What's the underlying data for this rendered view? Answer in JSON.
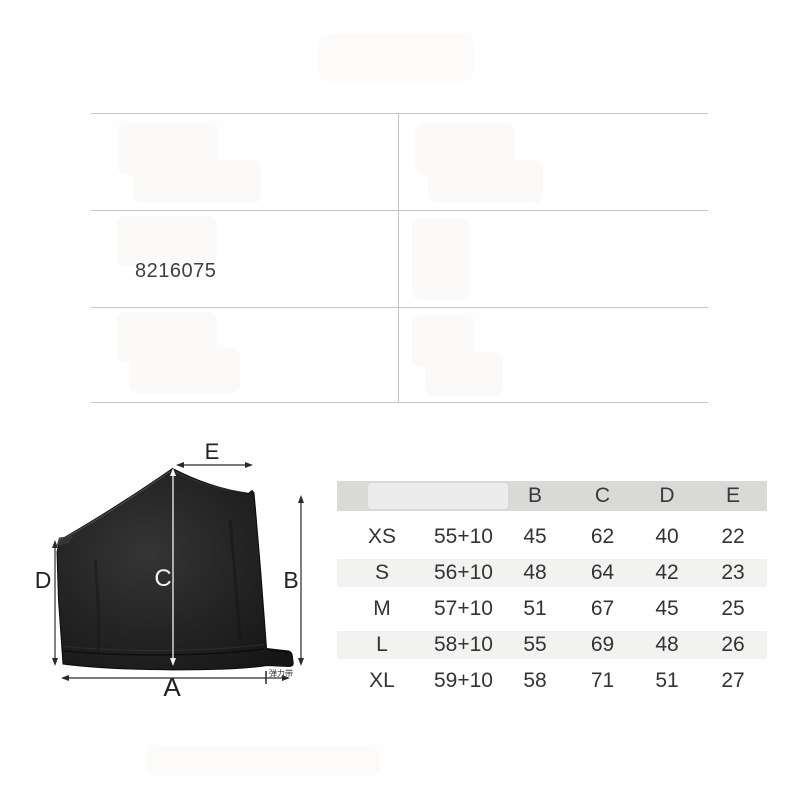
{
  "page": {
    "background": "#ffffff",
    "grid_line_color": "#c6c6c6"
  },
  "product_table": {
    "code": "8216075"
  },
  "diagram": {
    "garment": "black one-shoulder garment panel with elastic band tab",
    "garment_color": "#212121",
    "arrow_color": "#2a2a2a",
    "c_arrow_color": "#f2f2f2",
    "labels": {
      "a": "A",
      "b": "B",
      "c": "C",
      "d": "D",
      "e": "E",
      "elastic_band": "弹力带"
    }
  },
  "size_chart": {
    "header_bg": "#d9d9d8",
    "alt_row_bg": "#f2f2f1",
    "headers": [
      "",
      "",
      "B",
      "C",
      "D",
      "E"
    ],
    "rows": [
      [
        "XS",
        "55+10",
        "45",
        "62",
        "40",
        "22"
      ],
      [
        "S",
        "56+10",
        "48",
        "64",
        "42",
        "23"
      ],
      [
        "M",
        "57+10",
        "51",
        "67",
        "45",
        "25"
      ],
      [
        "L",
        "58+10",
        "55",
        "69",
        "48",
        "26"
      ],
      [
        "XL",
        "59+10",
        "58",
        "71",
        "51",
        "27"
      ]
    ]
  }
}
